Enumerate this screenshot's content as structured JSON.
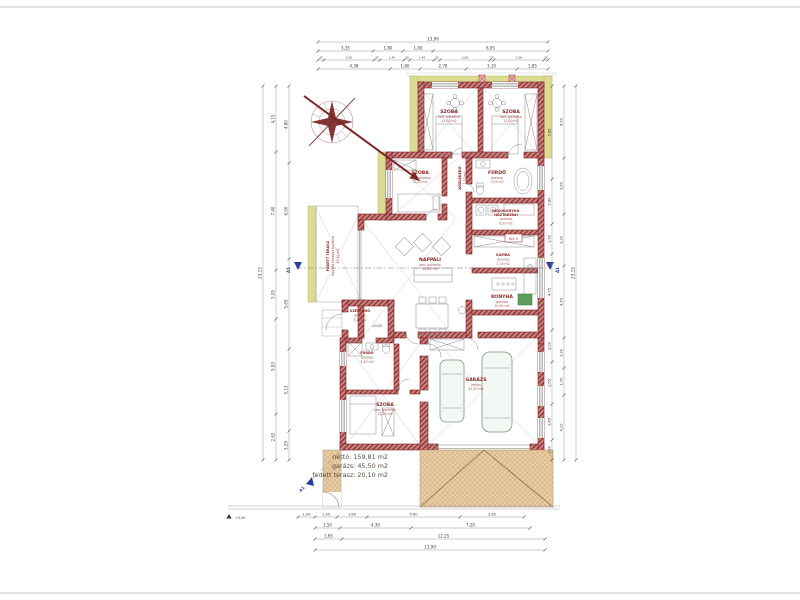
{
  "drawing": {
    "type_label": "családi ház alaprajz"
  },
  "rooms": {
    "szoba1": {
      "name": "SZOBA",
      "floor": "lam. parketta",
      "area": "12,00 m2"
    },
    "szoba2": {
      "name": "SZOBA",
      "floor": "lam. parketta",
      "area": "12,00 m2"
    },
    "szoba3": {
      "name": "SZOBA",
      "floor": "lam. parketta",
      "area": "12,20 m2"
    },
    "szoba4": {
      "name": "SZOBA",
      "floor": "lam. parketta",
      "area": "13,20 m2"
    },
    "furdo1": {
      "name": "FÜRDŐ",
      "floor": "greslap",
      "area": "7,05 m2"
    },
    "furdo2": {
      "name": "FÜRDŐ",
      "floor": "greslap",
      "area": "5,40 m2"
    },
    "mosokonyha": {
      "name_line1": "MOSÓKONYHA-",
      "name_line2": "HÁZTARTÁSI",
      "floor": "greslap",
      "area": "6,20 m2"
    },
    "kamra": {
      "name": "KAMRA",
      "floor": "greslap",
      "area": "2,16 m2"
    },
    "konyha": {
      "name": "KONYHA",
      "floor": "greslap",
      "area": "10,90 m2"
    },
    "nappali": {
      "name": "NAPPALI",
      "floor": "lam. parketta",
      "area": "32,60 m2"
    },
    "kozlekedo": {
      "name": "KÖZLEKEDŐ",
      "area": "7,70 m2"
    },
    "szelfogo": {
      "name": "SZÉLFOGÓ",
      "floor": "greslap",
      "area": "3,24 m2"
    },
    "garazs": {
      "name": "GARÁZS",
      "floor": "beton",
      "area": "45,50 m2"
    },
    "terasz": {
      "name": "FEDETT TERASZ",
      "floor": "fagyálló kerámia burkolat",
      "area": "20,10 m2"
    }
  },
  "summary": {
    "netto": "nettó: 159,81 m2",
    "garazs": "garázs: 45,50 m2",
    "terasz": "fedett terasz: 20,10 m2"
  },
  "markers": {
    "section": "A1",
    "level_entry": "±0,00",
    "level_ground": "+0,00",
    "meter_box": "621 V"
  },
  "dims": {
    "top_total": "13,90",
    "top_row2": [
      "3,35",
      "1,80",
      "1,80",
      "6,95"
    ],
    "top_row3": [
      "35",
      "3,00",
      "35",
      "1,45",
      "35",
      "1,45",
      "35",
      "3,00",
      "25",
      "3,00",
      "35"
    ],
    "top_row4": [
      "4,38",
      "1,80",
      "2,78",
      "3,10",
      "1,85"
    ],
    "bottom_row1": [
      "1,00",
      "1,35",
      "1,80",
      "5,60",
      "3,85"
    ],
    "bottom_row2": [
      "1,50",
      "4,30",
      "7,20"
    ],
    "bottom_row3": [
      "1,65",
      "12,25"
    ],
    "bottom_total": "13,90",
    "left_total": "23,15",
    "left_col2": [
      "4,15",
      "7,40",
      "3,05",
      "5,93",
      "2,62"
    ],
    "left_col3": [
      "4,80",
      "6,00",
      "5,65",
      "5,13",
      "3,29"
    ],
    "right_col1": [
      "5,85",
      "2,80",
      "1,90",
      "4,75",
      "2,00",
      "2,65",
      "3,45",
      "1,80"
    ],
    "right_col2": [
      "4,50",
      "3,50",
      "3,30",
      "4,50",
      "1,90",
      "1,70",
      "4,10"
    ],
    "right_total": "23,15"
  },
  "colors": {
    "wall": "#a03b3b",
    "insulation": "#d9d98f",
    "paving": "#e6c9a0",
    "section_marker": "#2b3f9e",
    "room_label": "#8c2727"
  }
}
